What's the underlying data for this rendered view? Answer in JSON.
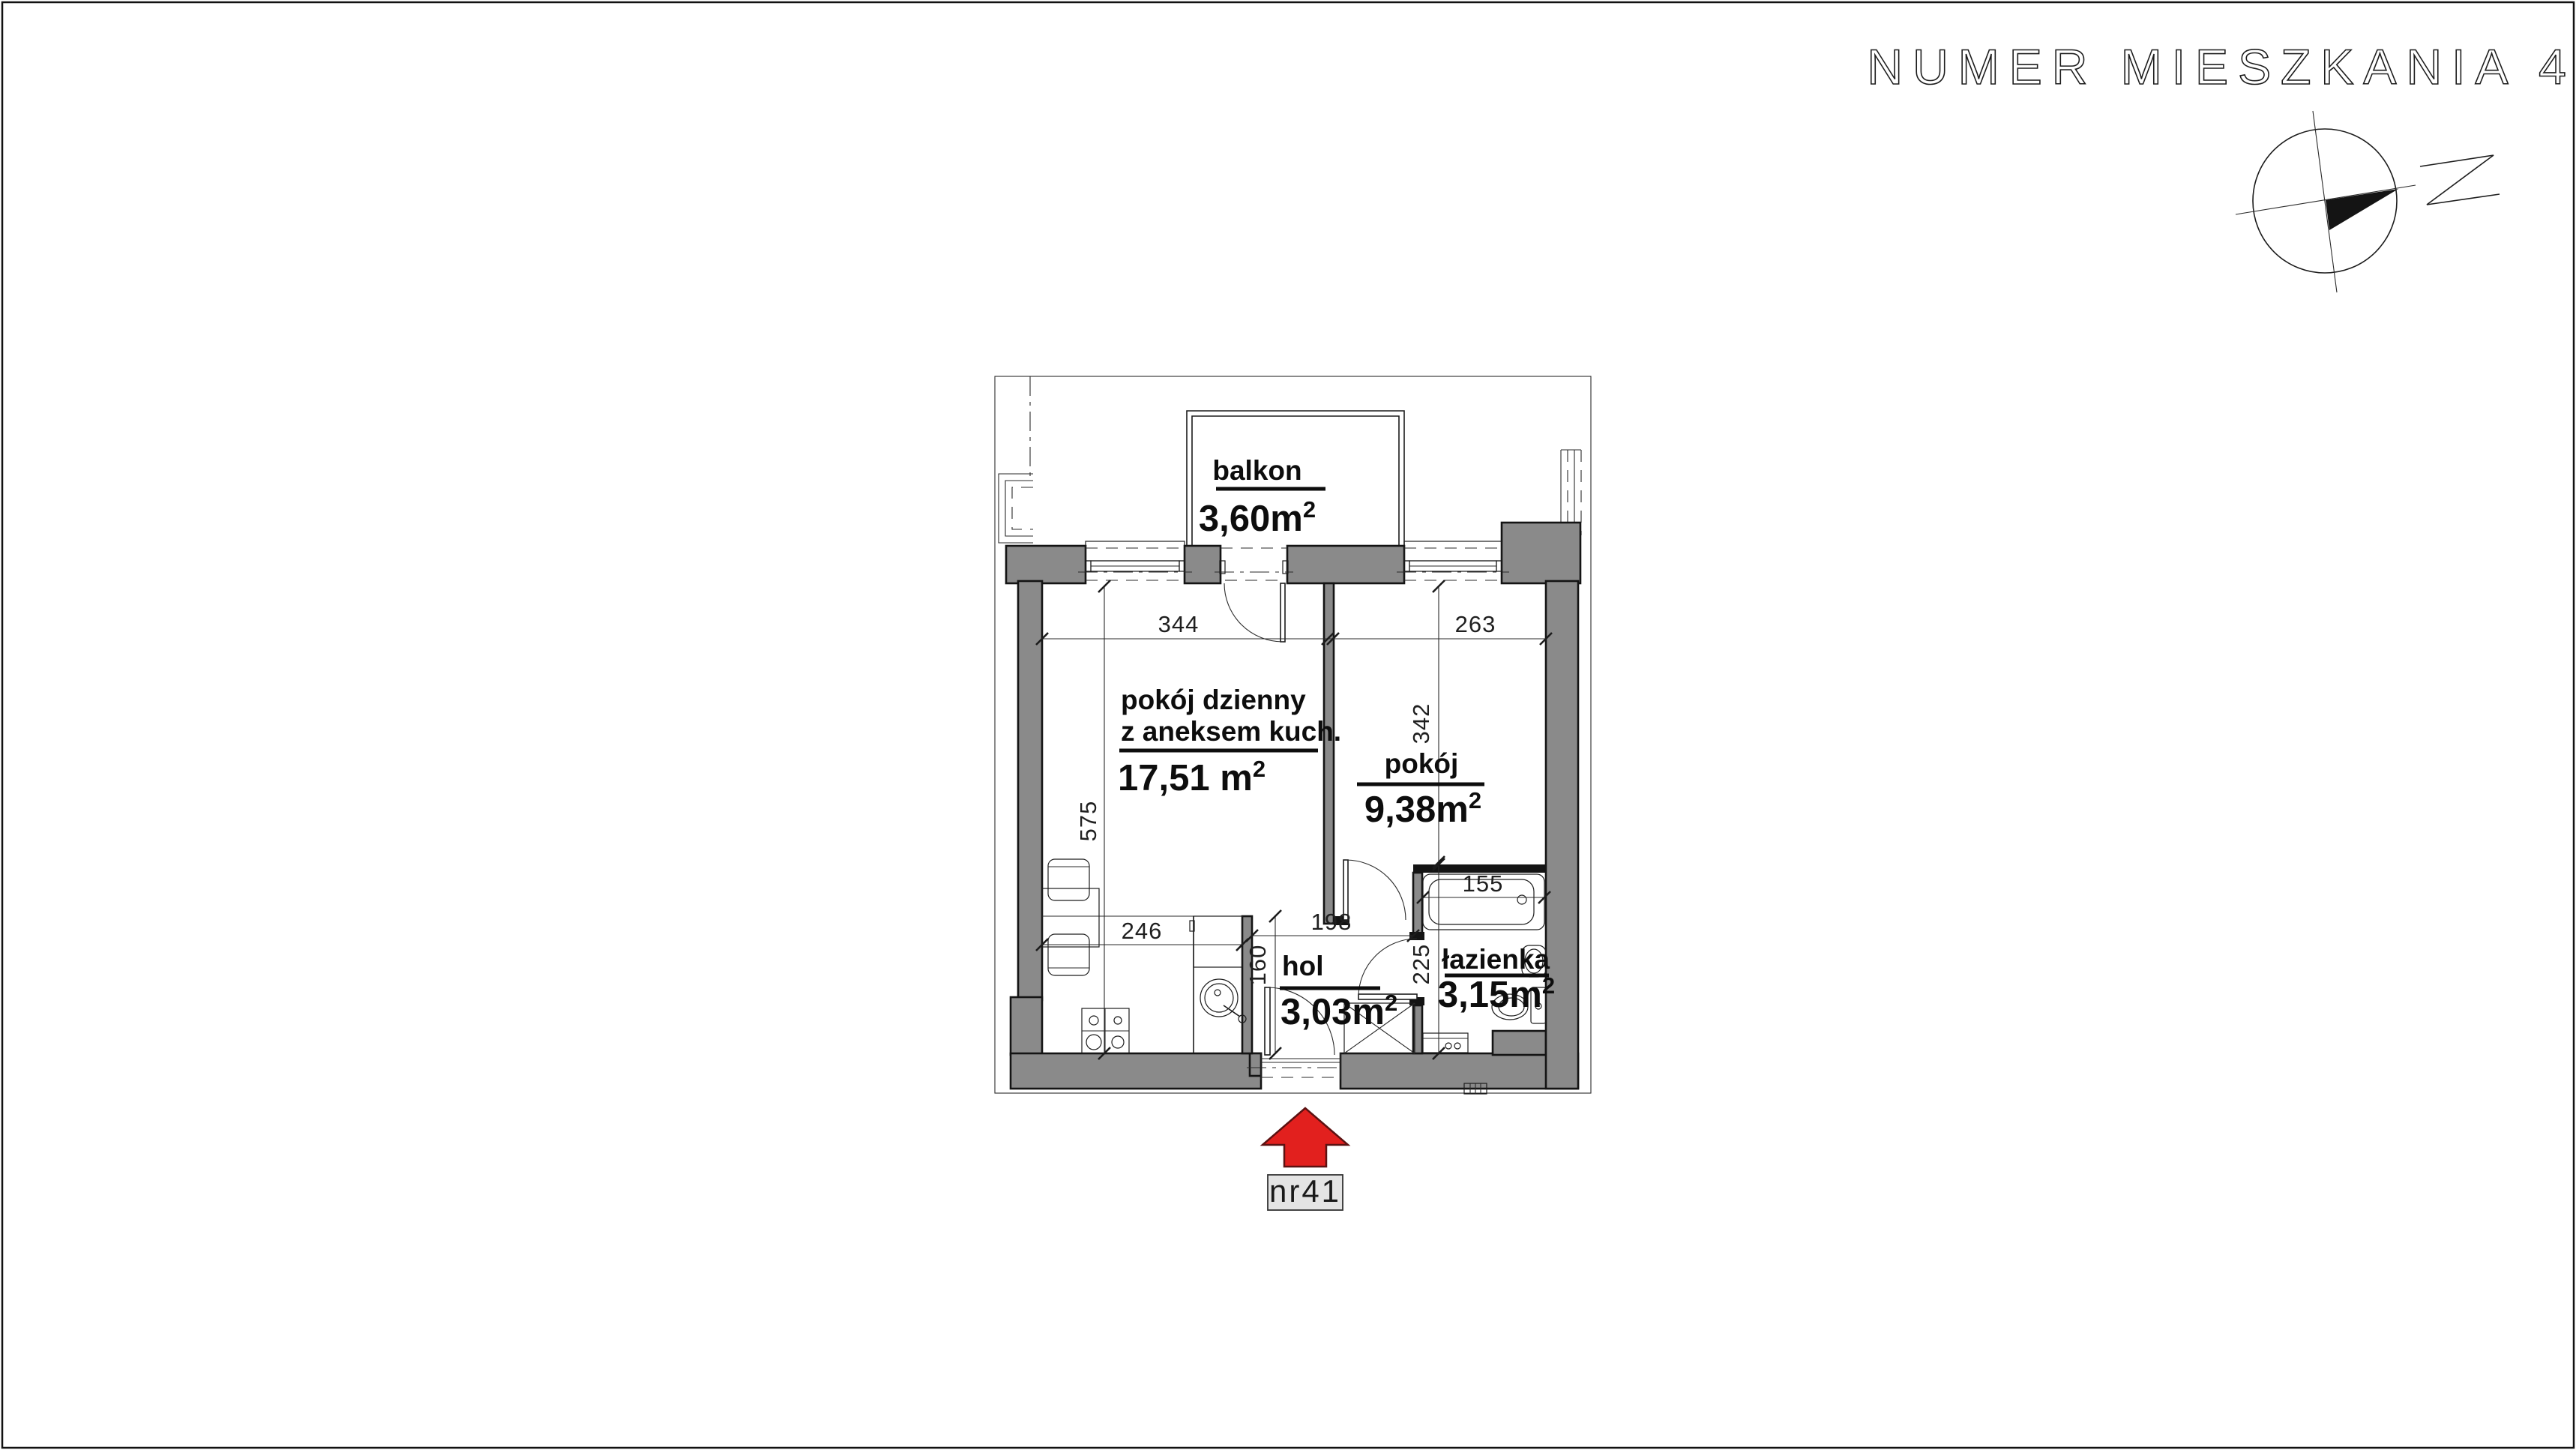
{
  "title": "NUMER MIESZKANIA 41",
  "compass": {
    "direction_label": "Z"
  },
  "rooms": [
    {
      "id": "balkon",
      "name": "balkon",
      "area": "3,60m",
      "area_sup": "2"
    },
    {
      "id": "living",
      "name_line1": "pokój dzienny",
      "name_line2": "z aneksem kuch.",
      "area": "17,51 m",
      "area_sup": "2"
    },
    {
      "id": "pokoj",
      "name": "pokój",
      "area": "9,38m",
      "area_sup": "2"
    },
    {
      "id": "hol",
      "name": "hol",
      "area": "3,03m",
      "area_sup": "2"
    },
    {
      "id": "lazienka",
      "name": "łazienka",
      "area": "3,15m",
      "area_sup": "2"
    }
  ],
  "dimensions_cm": {
    "living_room_width": "344",
    "bedroom_width": "263",
    "living_room_depth": "575",
    "bedroom_depth": "342",
    "kitchen_run": "246",
    "hall_width": "198",
    "hall_depth": "160",
    "bathroom_depth": "225",
    "bathtub_width": "155"
  },
  "entrance": {
    "label": "nr41"
  },
  "colors": {
    "wall_gray": "#8a8a8a",
    "arrow_red": "#e2201e",
    "label_box_gray": "#e4e4e4"
  }
}
